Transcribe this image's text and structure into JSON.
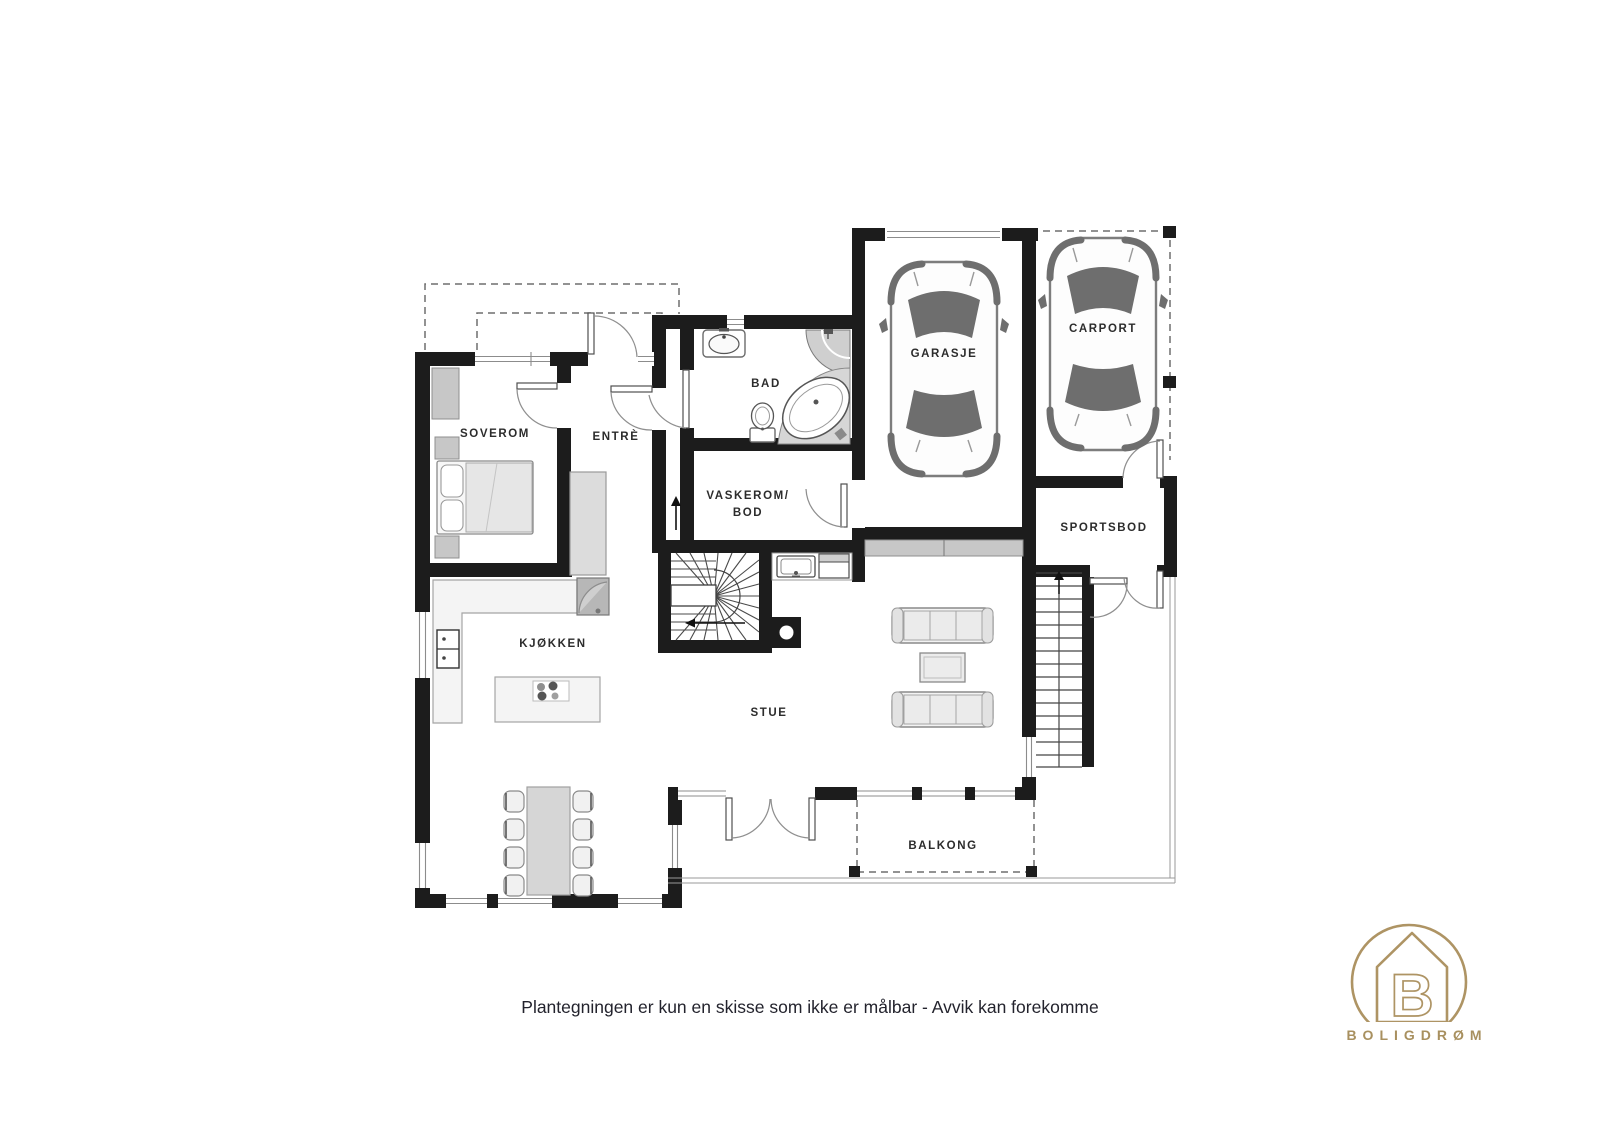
{
  "plan": {
    "rooms": [
      {
        "id": "soverom",
        "label": "SOVEROM"
      },
      {
        "id": "entre",
        "label": "ENTRÈ"
      },
      {
        "id": "bad",
        "label": "BAD"
      },
      {
        "id": "vaskerom-bod",
        "label": "VASKEROM/",
        "label2": "BOD"
      },
      {
        "id": "kjokken",
        "label": "KJØKKEN"
      },
      {
        "id": "stue",
        "label": "STUE"
      },
      {
        "id": "garasje",
        "label": "GARASJE"
      },
      {
        "id": "carport",
        "label": "CARPORT"
      },
      {
        "id": "sportsbod",
        "label": "SPORTSBOD"
      },
      {
        "id": "balkong",
        "label": "BALKONG"
      }
    ],
    "disclaimer": "Plantegningen er kun en skisse som ikke er målbar - Avvik kan forekomme",
    "logo": {
      "brand": "BOLIGDRØM",
      "monogram": "B"
    },
    "colors": {
      "wall": "#1c1c1c",
      "logo_gold": "#ae9464",
      "furniture_gray": "#c7c7c7",
      "label_text": "#2c2c2c"
    }
  }
}
